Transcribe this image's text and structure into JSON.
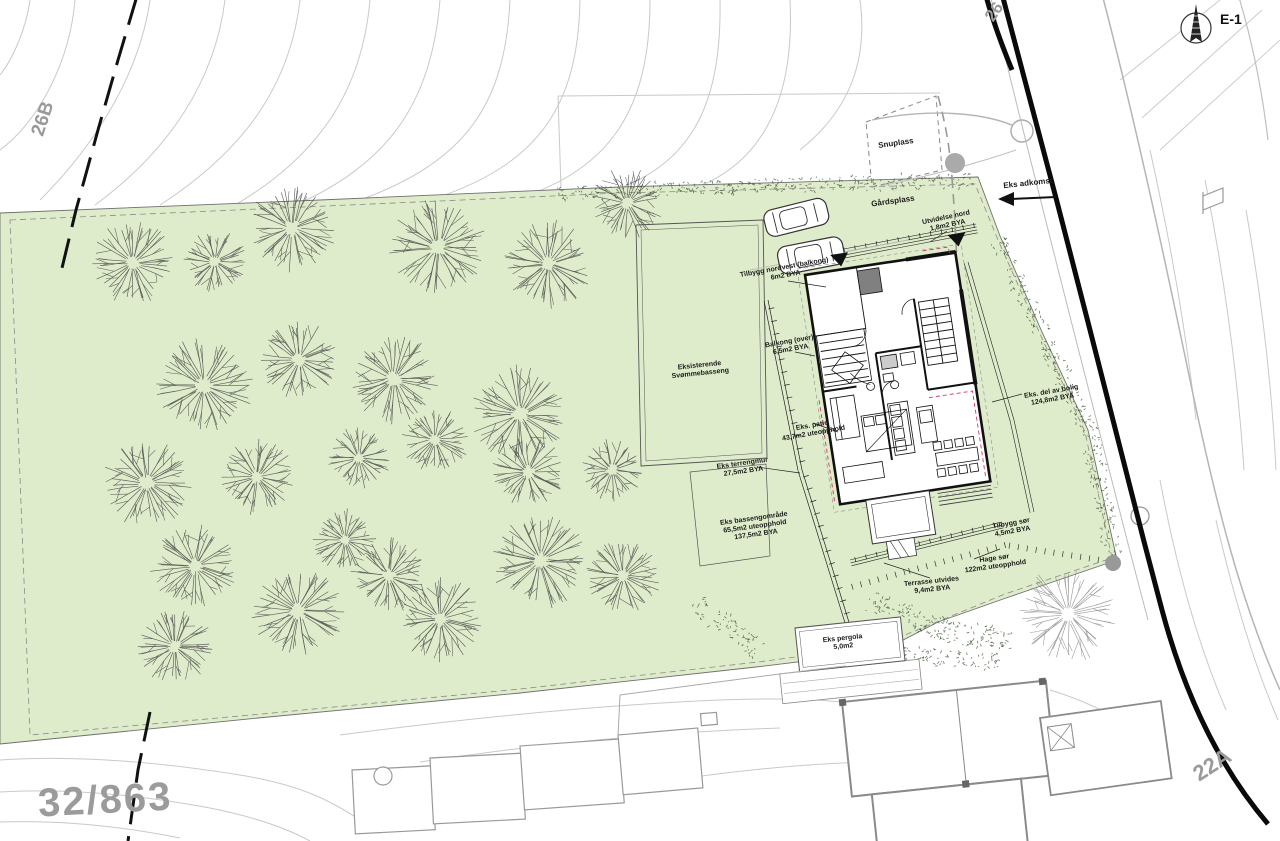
{
  "colors": {
    "parcel_green": "#dfeccb",
    "road_black": "#141414",
    "contour_gray": "#c9c9c9",
    "label_ink": "#1c1c1c",
    "muted_gray": "#9a9a9a",
    "red_dashed": "#d4356a",
    "tree_stroke": "#454545",
    "veg_stroke": "#39502f"
  },
  "north_arrow": {
    "label": "E-1"
  },
  "parcel": {
    "number": "32/863"
  },
  "addresses": {
    "top_left": "26B",
    "top_right": "26",
    "bottom_right": "22A"
  },
  "annotations": [
    {
      "id": "snuplass",
      "lines": [
        "Snuplass"
      ],
      "x": 896,
      "y": 144,
      "rot": -8,
      "size": 8
    },
    {
      "id": "gardsplass",
      "lines": [
        "Gårdsplass"
      ],
      "x": 893,
      "y": 202,
      "rot": -8,
      "size": 8
    },
    {
      "id": "eks-adkomst",
      "lines": [
        "Eks adkomst"
      ],
      "x": 1028,
      "y": 184,
      "rot": -6,
      "size": 8
    },
    {
      "id": "utvidelse-nord",
      "lines": [
        "Utvidelse nord",
        "1,8m2 BYA"
      ],
      "x": 947,
      "y": 222,
      "rot": -12
    },
    {
      "id": "tilbygg-nordvest",
      "lines": [
        "Tilbygg nordvest (balkong)",
        "6m2 BYA"
      ],
      "x": 785,
      "y": 272,
      "rot": -10
    },
    {
      "id": "balkong-over",
      "lines": [
        "Balkong (over)",
        "6,5m2 BYA"
      ],
      "x": 790,
      "y": 346,
      "rot": -10
    },
    {
      "id": "svommebasseng",
      "lines": [
        "Eksisterende",
        "Svømmebasseng"
      ],
      "x": 700,
      "y": 370,
      "rot": -6
    },
    {
      "id": "eks-patio",
      "lines": [
        "Eks. patio",
        "43,7m2 uteopphold"
      ],
      "x": 813,
      "y": 430,
      "rot": -10
    },
    {
      "id": "eks-terrengmur",
      "lines": [
        "Eks terrengmur",
        "27,5m2 BYA"
      ],
      "x": 743,
      "y": 468,
      "rot": -8
    },
    {
      "id": "eks-bassengomrade",
      "lines": [
        "Eks bassengområde",
        "65,5m2 uteopphold",
        "137,5m2 BYA"
      ],
      "x": 755,
      "y": 527,
      "rot": -8
    },
    {
      "id": "eks-del-av-bolig",
      "lines": [
        "Eks. del av bolig",
        "124,8m2 BYA"
      ],
      "x": 1052,
      "y": 396,
      "rot": -10
    },
    {
      "id": "tilbygg-sor",
      "lines": [
        "Tilbygg sør",
        "4,5m2 BYA"
      ],
      "x": 1012,
      "y": 528,
      "rot": -10
    },
    {
      "id": "hage-sor",
      "lines": [
        "Hage sør",
        "122m2  uteopphold"
      ],
      "x": 995,
      "y": 563,
      "rot": -8
    },
    {
      "id": "terrasse-utvides",
      "lines": [
        "Terrasse utvides",
        "9,4m2 BYA"
      ],
      "x": 932,
      "y": 586,
      "rot": -6
    },
    {
      "id": "eks-pergola",
      "lines": [
        "Eks pergola",
        "5,0m2"
      ],
      "x": 843,
      "y": 643,
      "rot": -6
    }
  ],
  "site": {
    "trees": [
      [
        133,
        263,
        40
      ],
      [
        215,
        262,
        30
      ],
      [
        292,
        228,
        42
      ],
      [
        438,
        247,
        46
      ],
      [
        548,
        264,
        42
      ],
      [
        627,
        203,
        34
      ],
      [
        204,
        386,
        46
      ],
      [
        299,
        360,
        38
      ],
      [
        394,
        379,
        42
      ],
      [
        520,
        414,
        46
      ],
      [
        147,
        483,
        42
      ],
      [
        257,
        477,
        36
      ],
      [
        359,
        458,
        30
      ],
      [
        435,
        440,
        32
      ],
      [
        528,
        472,
        34
      ],
      [
        612,
        470,
        30
      ],
      [
        195,
        566,
        42
      ],
      [
        298,
        611,
        44
      ],
      [
        389,
        576,
        36
      ],
      [
        440,
        619,
        40
      ],
      [
        540,
        561,
        46
      ],
      [
        623,
        576,
        36
      ],
      [
        175,
        646,
        36
      ],
      [
        345,
        540,
        30
      ]
    ],
    "gray_tree": [
      1068,
      614,
      46
    ]
  }
}
